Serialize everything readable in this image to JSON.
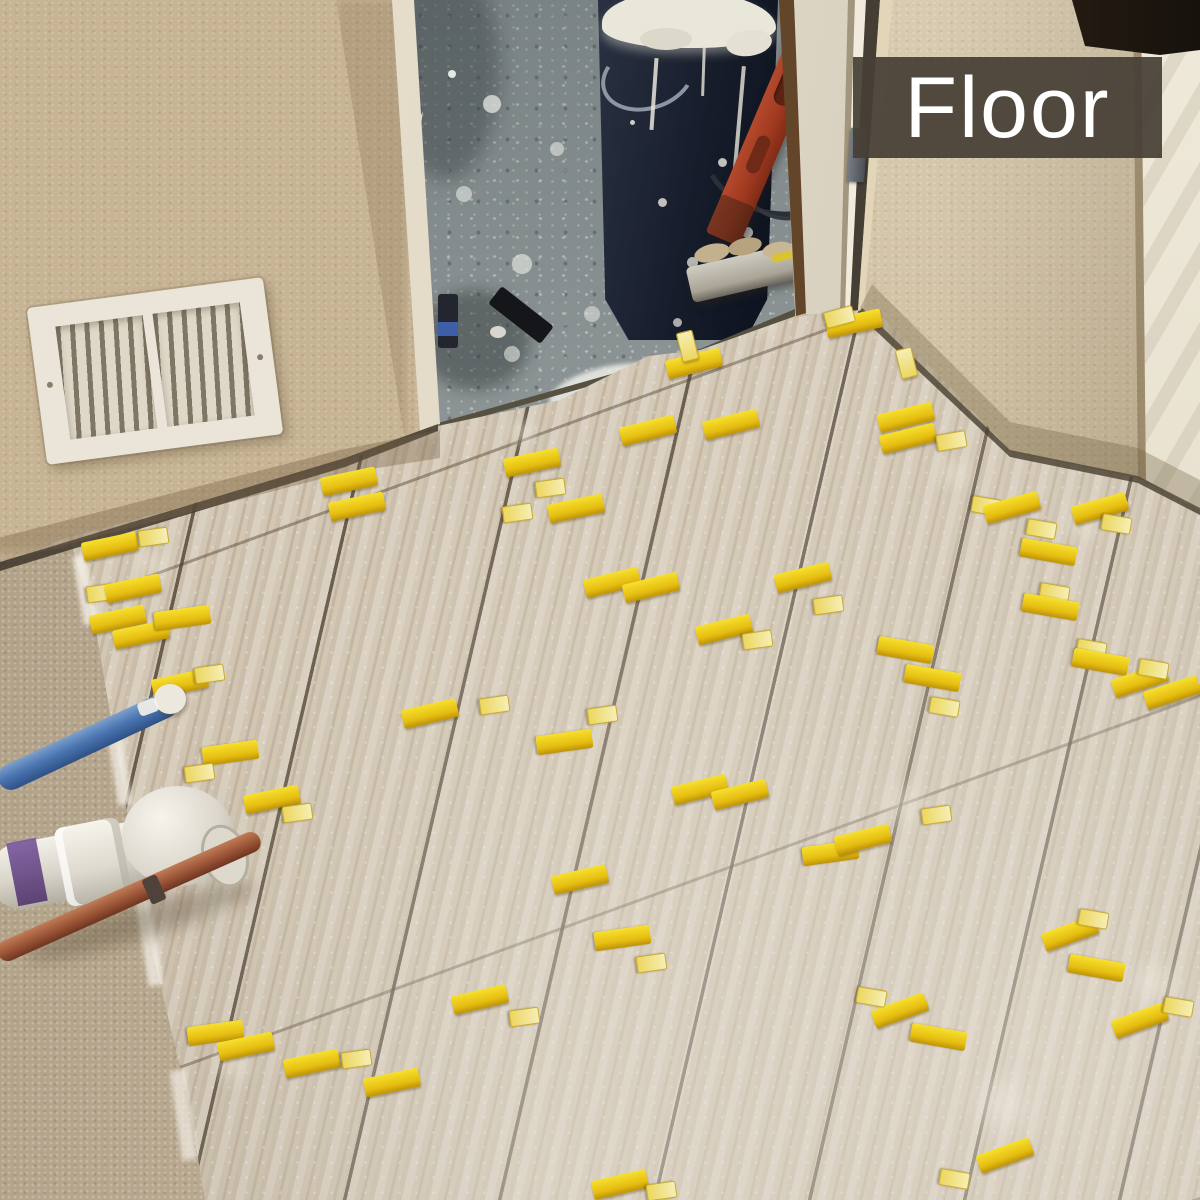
{
  "overlay": {
    "label": "Floor",
    "bg": "#473f36",
    "text_color": "#ffffff"
  },
  "colors": {
    "wall": "#c7b494",
    "substrate": "#bcab90",
    "tile": "#d2c6b3",
    "grout": "#4b3e30",
    "clip_yellow": "#e5bd10",
    "concrete": "#8d9596",
    "bucket_navy": "#1c2333",
    "level_red": "#a63d24",
    "pex_blue": "#4a74b0",
    "copper_pipe": "#9a5436",
    "pvc_white": "#efece4",
    "pvc_primer_purple": "#6d4f92",
    "vent_white": "#eae5d8",
    "door_jamb": "#efe9dc",
    "door_trim_brown": "#63452a"
  },
  "clips": {
    "types": [
      "wedge-horizontal",
      "wedge-vertical",
      "clip-stub"
    ],
    "items": [
      [
        694,
        363,
        -14,
        0
      ],
      [
        686,
        345,
        -14,
        2
      ],
      [
        731,
        424,
        -14,
        0
      ],
      [
        854,
        323,
        -12,
        0
      ],
      [
        838,
        316,
        75,
        2
      ],
      [
        906,
        417,
        -14,
        0
      ],
      [
        908,
        438,
        -14,
        0
      ],
      [
        950,
        440,
        80,
        2
      ],
      [
        349,
        481,
        -12,
        0
      ],
      [
        357,
        506,
        -12,
        0
      ],
      [
        532,
        462,
        -12,
        0
      ],
      [
        549,
        487,
        82,
        2
      ],
      [
        516,
        512,
        82,
        2
      ],
      [
        576,
        508,
        -12,
        0
      ],
      [
        612,
        582,
        -14,
        0
      ],
      [
        651,
        587,
        -14,
        0
      ],
      [
        803,
        577,
        -14,
        0
      ],
      [
        827,
        604,
        82,
        2
      ],
      [
        724,
        629,
        -14,
        0
      ],
      [
        756,
        639,
        82,
        2
      ],
      [
        985,
        505,
        100,
        2
      ],
      [
        1012,
        507,
        -16,
        0
      ],
      [
        1100,
        508,
        -16,
        0
      ],
      [
        1115,
        523,
        100,
        2
      ],
      [
        1040,
        528,
        100,
        2
      ],
      [
        1048,
        552,
        100,
        1
      ],
      [
        1053,
        592,
        100,
        2
      ],
      [
        1050,
        607,
        100,
        1
      ],
      [
        1090,
        648,
        100,
        2
      ],
      [
        1100,
        662,
        100,
        1
      ],
      [
        1140,
        680,
        -18,
        0
      ],
      [
        1172,
        692,
        -18,
        0
      ],
      [
        1152,
        668,
        100,
        2
      ],
      [
        905,
        650,
        100,
        1
      ],
      [
        932,
        678,
        100,
        1
      ],
      [
        943,
        706,
        100,
        2
      ],
      [
        110,
        546,
        -12,
        0
      ],
      [
        152,
        536,
        82,
        2
      ],
      [
        100,
        592,
        82,
        2
      ],
      [
        133,
        588,
        -12,
        0
      ],
      [
        118,
        619,
        -12,
        0
      ],
      [
        141,
        634,
        -12,
        0
      ],
      [
        182,
        618,
        82,
        1
      ],
      [
        180,
        683,
        -12,
        0
      ],
      [
        208,
        673,
        82,
        2
      ],
      [
        230,
        753,
        82,
        1
      ],
      [
        198,
        772,
        82,
        2
      ],
      [
        272,
        799,
        -12,
        0
      ],
      [
        296,
        812,
        82,
        2
      ],
      [
        430,
        713,
        -13,
        0
      ],
      [
        493,
        704,
        82,
        2
      ],
      [
        564,
        742,
        82,
        1
      ],
      [
        601,
        714,
        82,
        2
      ],
      [
        700,
        789,
        -14,
        0
      ],
      [
        740,
        794,
        -14,
        0
      ],
      [
        830,
        853,
        82,
        1
      ],
      [
        863,
        839,
        -14,
        0
      ],
      [
        935,
        814,
        82,
        2
      ],
      [
        580,
        879,
        -13,
        0
      ],
      [
        622,
        938,
        82,
        1
      ],
      [
        650,
        962,
        82,
        2
      ],
      [
        480,
        999,
        -13,
        0
      ],
      [
        523,
        1016,
        82,
        2
      ],
      [
        900,
        1010,
        -20,
        0
      ],
      [
        870,
        996,
        100,
        2
      ],
      [
        938,
        1037,
        100,
        1
      ],
      [
        1070,
        933,
        -20,
        0
      ],
      [
        1096,
        968,
        100,
        1
      ],
      [
        1092,
        918,
        100,
        2
      ],
      [
        1140,
        1020,
        -20,
        0
      ],
      [
        1177,
        1006,
        100,
        2
      ],
      [
        215,
        1033,
        82,
        1
      ],
      [
        246,
        1046,
        -12,
        0
      ],
      [
        312,
        1063,
        -12,
        0
      ],
      [
        355,
        1058,
        82,
        2
      ],
      [
        392,
        1082,
        -12,
        0
      ],
      [
        1005,
        1155,
        -20,
        0
      ],
      [
        953,
        1178,
        100,
        2
      ],
      [
        620,
        1184,
        -13,
        0
      ],
      [
        660,
        1190,
        82,
        2
      ],
      [
        648,
        430,
        -14,
        0
      ],
      [
        905,
        362,
        -14,
        2
      ]
    ]
  }
}
